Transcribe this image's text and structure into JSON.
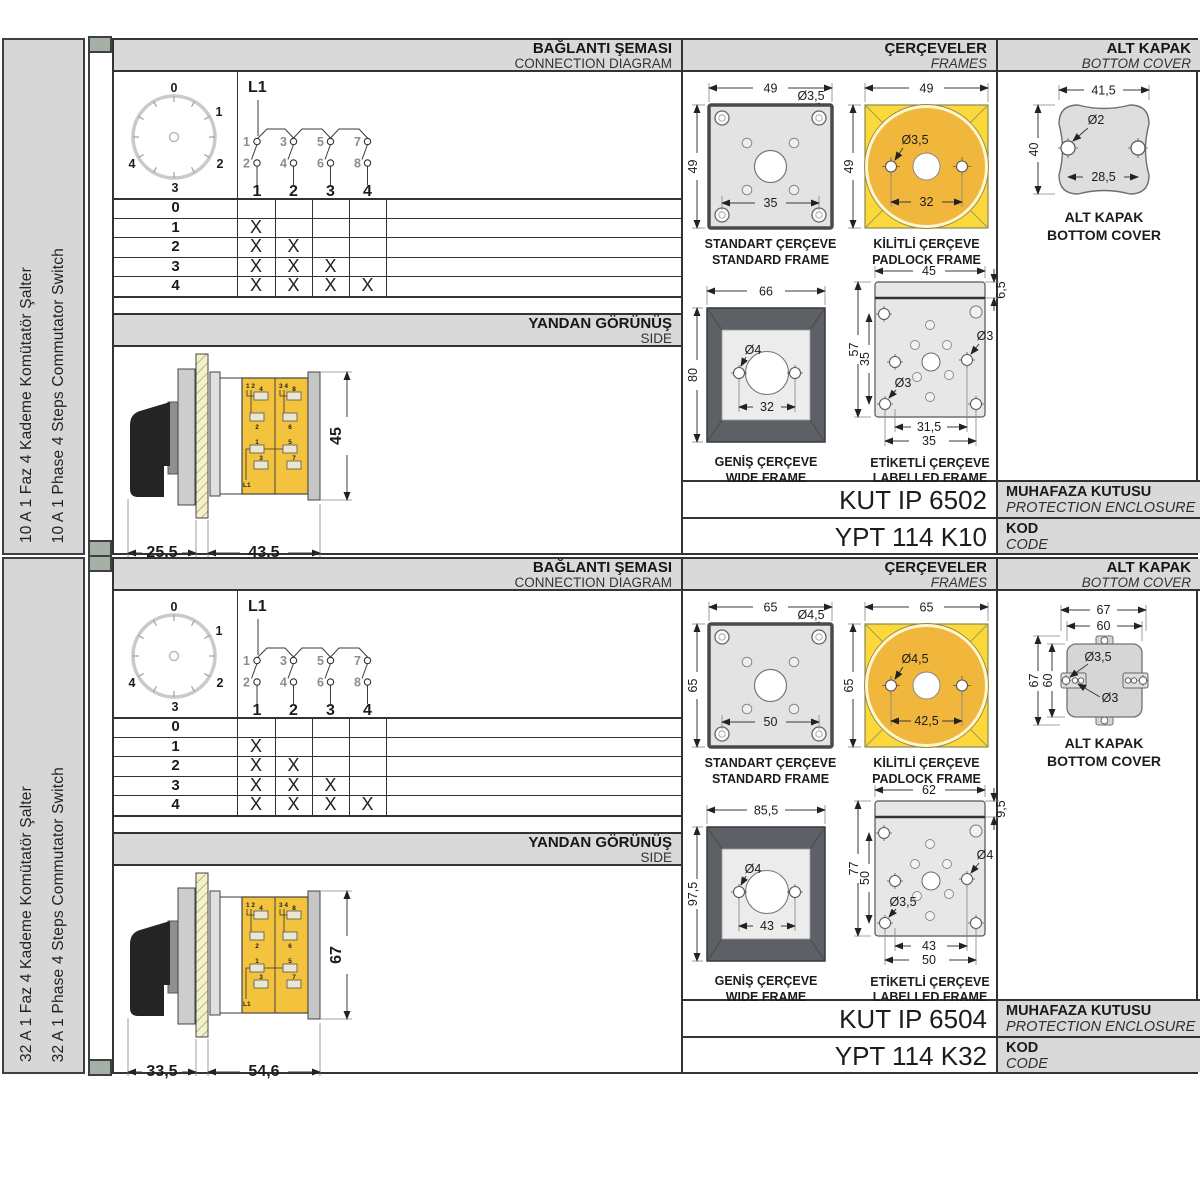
{
  "sections": [
    {
      "sidebar": {
        "title_tr": "10 A 1 Faz 4 Kademe Komütatör Şalter",
        "title_en": "10 A 1 Phase 4 Steps Commutator Switch"
      },
      "headers": {
        "connection_tr": "BAĞLANTI ŞEMASI",
        "connection_en": "CONNECTION DIAGRAM",
        "frames_tr": "ÇERÇEVELER",
        "frames_en": "FRAMES",
        "cover_tr": "ALT KAPAK",
        "cover_en": "BOTTOM COVER"
      },
      "connection": {
        "dial_labels": [
          "0",
          "1",
          "2",
          "3",
          "4"
        ],
        "l1_label": "L1",
        "contacts_top": [
          "1",
          "3",
          "5",
          "7"
        ],
        "contacts_bottom": [
          "2",
          "4",
          "6",
          "8"
        ],
        "pole_numbers": [
          "1",
          "2",
          "3",
          "4"
        ],
        "table_rows": [
          {
            "label": "0",
            "m": [
              "",
              "",
              "",
              ""
            ]
          },
          {
            "label": "1",
            "m": [
              "X",
              "",
              "",
              ""
            ]
          },
          {
            "label": "2",
            "m": [
              "X",
              "X",
              "",
              ""
            ]
          },
          {
            "label": "3",
            "m": [
              "X",
              "X",
              "X",
              ""
            ]
          },
          {
            "label": "4",
            "m": [
              "X",
              "X",
              "X",
              "X"
            ]
          }
        ]
      },
      "side_view": {
        "label_tr": "YANDAN GÖRÜNÜŞ",
        "label_en": "SIDE",
        "dim_front": "25,5",
        "dim_body": "43,5",
        "dim_height": "45",
        "terminals": {
          "left_top": "1 2",
          "right_top": "3 4",
          "left": [
            "4",
            "2",
            "1",
            "3"
          ],
          "right": [
            "8",
            "6",
            "5",
            "7"
          ],
          "feed": "L1"
        }
      },
      "frames": {
        "standard": {
          "title_tr": "STANDART ÇERÇEVE",
          "title_en": "STANDARD FRAME",
          "dim_width": "49",
          "dim_height": "49",
          "dim_hole": "Ø3,5",
          "dim_inner": "35"
        },
        "padlock": {
          "title_tr": "KİLİTLİ ÇERÇEVE",
          "title_en": "PADLOCK FRAME",
          "dim_width": "49",
          "dim_height": "49",
          "dim_hole": "Ø3,5",
          "dim_inner": "32"
        },
        "wide": {
          "title_tr": "GENİŞ ÇERÇEVE",
          "title_en": "WIDE FRAME",
          "dim_width": "66",
          "dim_height": "80",
          "dim_hole": "Ø4",
          "dim_inner": "32"
        },
        "labelled": {
          "title_tr": "ETİKETLİ ÇERÇEVE",
          "title_en": "LABELLED FRAME",
          "dim_width": "45",
          "dim_strip": "6,5",
          "dim_height": "57",
          "dim_inner_height": "35",
          "dim_hole_right": "Ø3",
          "dim_hole_bottom": "Ø3",
          "dim_bottom_inner": "31,5",
          "dim_bottom_outer": "35"
        }
      },
      "cover": {
        "title_tr": "ALT KAPAK",
        "title_en": "BOTTOM COVER",
        "dim_width": "41,5",
        "dim_height": "40",
        "dim_hole": "Ø2",
        "dim_span": "28,5"
      },
      "codes": {
        "enclosure_value": "KUT IP 6502",
        "enclosure_label_tr": "MUHAFAZA KUTUSU",
        "enclosure_label_en": "PROTECTION ENCLOSURE",
        "code_value": "YPT 114 K10",
        "code_label_tr": "KOD",
        "code_label_en": "CODE"
      }
    },
    {
      "sidebar": {
        "title_tr": "32 A 1 Faz 4 Kademe Komütatör Şalter",
        "title_en": "32 A 1 Phase 4 Steps Commutator Switch"
      },
      "headers": {
        "connection_tr": "BAĞLANTI ŞEMASI",
        "connection_en": "CONNECTION DIAGRAM",
        "frames_tr": "ÇERÇEVELER",
        "frames_en": "FRAMES",
        "cover_tr": "ALT KAPAK",
        "cover_en": "BOTTOM COVER"
      },
      "connection": {
        "dial_labels": [
          "0",
          "1",
          "2",
          "3",
          "4"
        ],
        "l1_label": "L1",
        "contacts_top": [
          "1",
          "3",
          "5",
          "7"
        ],
        "contacts_bottom": [
          "2",
          "4",
          "6",
          "8"
        ],
        "pole_numbers": [
          "1",
          "2",
          "3",
          "4"
        ],
        "table_rows": [
          {
            "label": "0",
            "m": [
              "",
              "",
              "",
              ""
            ]
          },
          {
            "label": "1",
            "m": [
              "X",
              "",
              "",
              ""
            ]
          },
          {
            "label": "2",
            "m": [
              "X",
              "X",
              "",
              ""
            ]
          },
          {
            "label": "3",
            "m": [
              "X",
              "X",
              "X",
              ""
            ]
          },
          {
            "label": "4",
            "m": [
              "X",
              "X",
              "X",
              "X"
            ]
          }
        ]
      },
      "side_view": {
        "label_tr": "YANDAN GÖRÜNÜŞ",
        "label_en": "SIDE",
        "dim_front": "33,5",
        "dim_body": "54,6",
        "dim_height": "67",
        "terminals": {
          "left_top": "1 2",
          "right_top": "3 4",
          "left": [
            "4",
            "2",
            "1",
            "3"
          ],
          "right": [
            "8",
            "6",
            "5",
            "7"
          ],
          "feed": "L1"
        }
      },
      "frames": {
        "standard": {
          "title_tr": "STANDART ÇERÇEVE",
          "title_en": "STANDARD FRAME",
          "dim_width": "65",
          "dim_height": "65",
          "dim_hole": "Ø4,5",
          "dim_inner": "50"
        },
        "padlock": {
          "title_tr": "KİLİTLİ ÇERÇEVE",
          "title_en": "PADLOCK FRAME",
          "dim_width": "65",
          "dim_height": "65",
          "dim_hole": "Ø4,5",
          "dim_inner": "42,5"
        },
        "wide": {
          "title_tr": "GENİŞ ÇERÇEVE",
          "title_en": "WIDE FRAME",
          "dim_width": "85,5",
          "dim_height": "97,5",
          "dim_hole": "Ø4",
          "dim_inner": "43"
        },
        "labelled": {
          "title_tr": "ETİKETLİ ÇERÇEVE",
          "title_en": "LABELLED FRAME",
          "dim_width": "62",
          "dim_strip": "9,5",
          "dim_height": "77",
          "dim_inner_height": "50",
          "dim_hole_right": "Ø4",
          "dim_hole_bottom": "Ø3,5",
          "dim_bottom_inner": "43",
          "dim_bottom_outer": "50"
        }
      },
      "cover": {
        "title_tr": "ALT KAPAK",
        "title_en": "BOTTOM COVER",
        "dim_outer_w": "67",
        "dim_inner_w": "60",
        "dim_outer_h": "67",
        "dim_inner_h": "60",
        "dim_hole_big": "Ø3,5",
        "dim_hole_small": "Ø3"
      },
      "codes": {
        "enclosure_value": "KUT IP 6504",
        "enclosure_label_tr": "MUHAFAZA KUTUSU",
        "enclosure_label_en": "PROTECTION ENCLOSURE",
        "code_value": "YPT 114 K32",
        "code_label_tr": "KOD",
        "code_label_en": "CODE"
      }
    }
  ]
}
